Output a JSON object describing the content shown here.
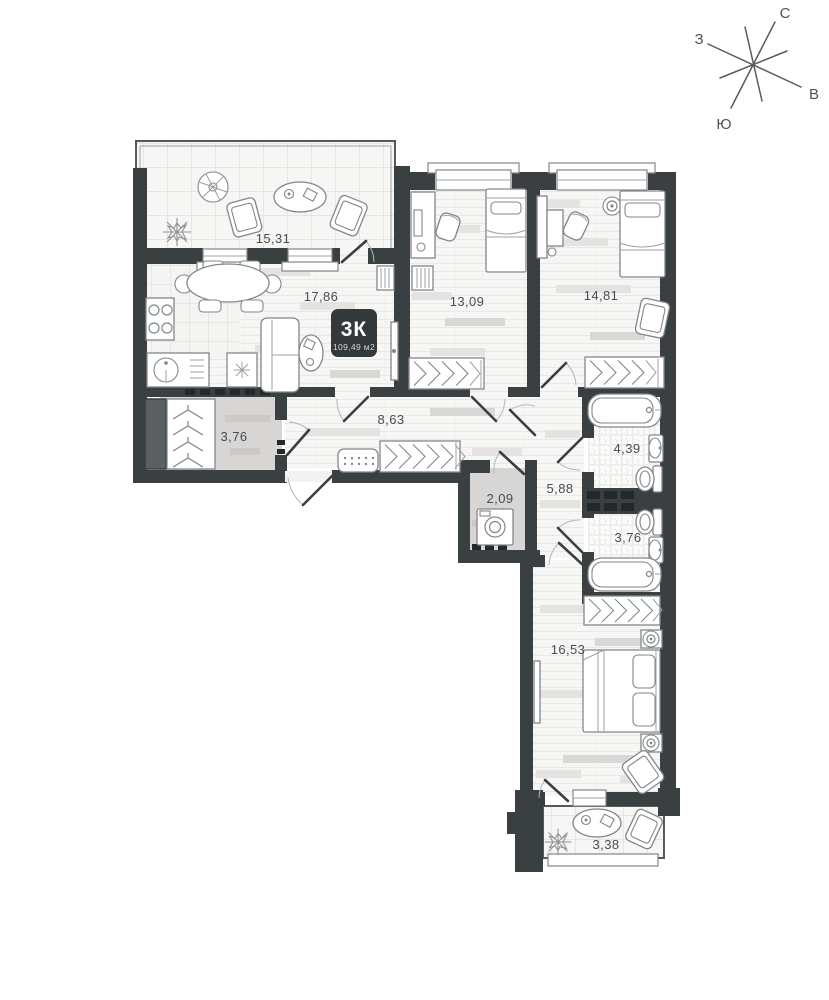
{
  "compass": {
    "north": "С",
    "west": "З",
    "east": "В",
    "south": "Ю"
  },
  "badge": {
    "type": "3К",
    "area": "109,49 м2"
  },
  "rooms": {
    "balcony_top": {
      "area": "15,31"
    },
    "living_kitchen": {
      "area": "17,86"
    },
    "bedroom_1": {
      "area": "13,09"
    },
    "bedroom_2": {
      "area": "14,81"
    },
    "hallway": {
      "area": "8,63"
    },
    "wardrobe": {
      "area": "3,76"
    },
    "bathroom_1": {
      "area": "4,39"
    },
    "hall_2": {
      "area": "5,88"
    },
    "laundry": {
      "area": "2,09"
    },
    "bathroom_2": {
      "area": "3,76"
    },
    "bedroom_3": {
      "area": "16,53"
    },
    "balcony_bottom": {
      "area": "3,38"
    }
  }
}
